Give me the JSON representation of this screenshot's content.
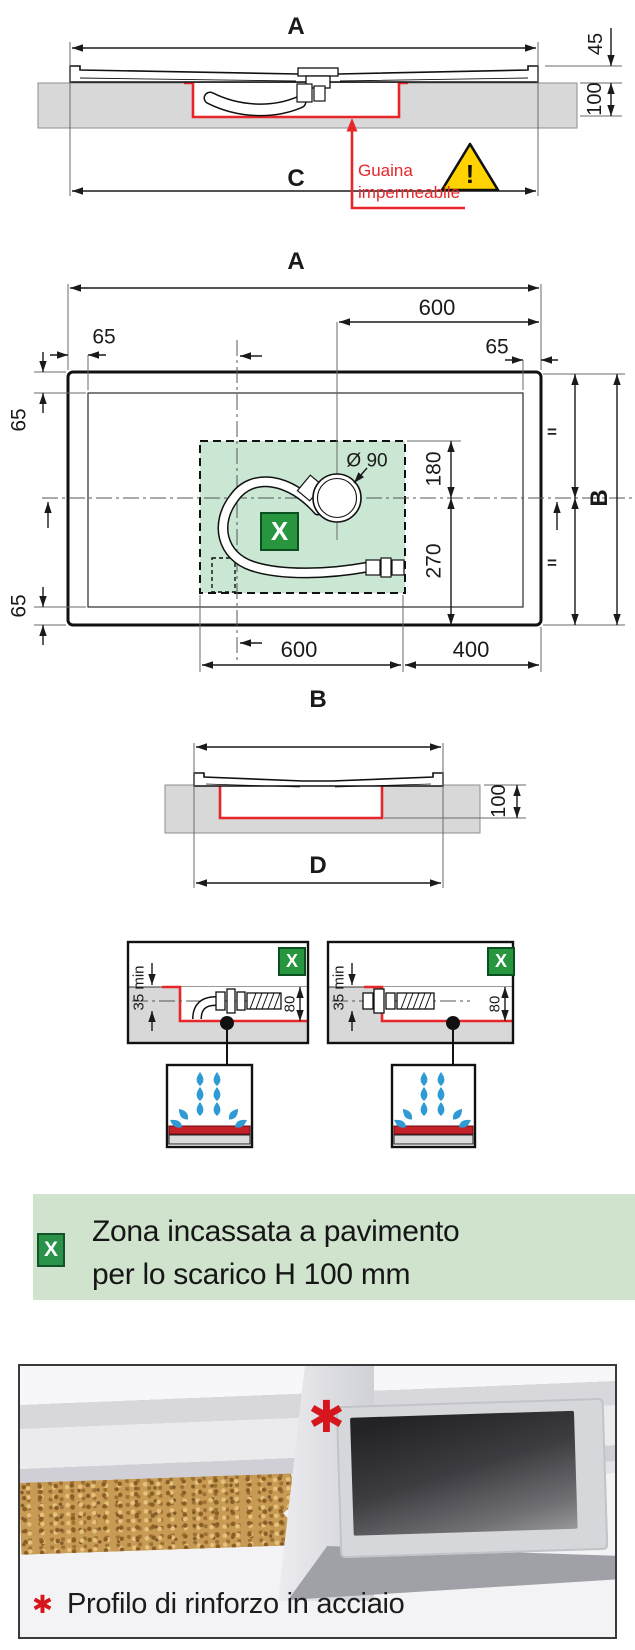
{
  "palette": {
    "accent_red": "#e8262a",
    "line_black": "#1a1a1a",
    "slab_gray": "#d8d8d8",
    "zone_green_fill": "#c9e7d2",
    "marker_green": "#28953f",
    "banner_green": "#cfe3cd",
    "drop_blue": "#2f9ad3",
    "warning_yellow": "#ffd200",
    "wood_tan": "#c79b53"
  },
  "section_top": {
    "label_a": "A",
    "label_c": "C",
    "dim_tray_height": "45",
    "dim_recess_depth": "100",
    "membrane_line1": "Guaina",
    "membrane_line2": "impermeabile",
    "warning_mark": "!"
  },
  "section_plan": {
    "label_a": "A",
    "dim_600_top": "600",
    "dim_65_top_left": "65",
    "dim_65_top_right": "65",
    "dim_65_left_top": "65",
    "dim_65_left_bottom": "65",
    "drain_diameter": "Ø 90",
    "dim_180": "180",
    "dim_270": "270",
    "label_b": "B",
    "dim_600_bottom": "600",
    "dim_400": "400",
    "zone_marker": "X",
    "equal_top": "=",
    "equal_bottom": "="
  },
  "section_b": {
    "label_b": "B",
    "dim_100": "100",
    "label_d": "D"
  },
  "details": {
    "left": {
      "marker": "X",
      "dim_min": "35 min",
      "dim_80": "80"
    },
    "right": {
      "marker": "X",
      "dim_min": "35 min",
      "dim_80": "80"
    }
  },
  "legend": {
    "marker": "X",
    "line1": "Zona incassata a pavimento",
    "line2": "per lo scarico H 100 mm"
  },
  "photo": {
    "asterisk": "✱",
    "caption_asterisk": "✱",
    "caption": "Profilo di rinforzo in acciaio"
  }
}
